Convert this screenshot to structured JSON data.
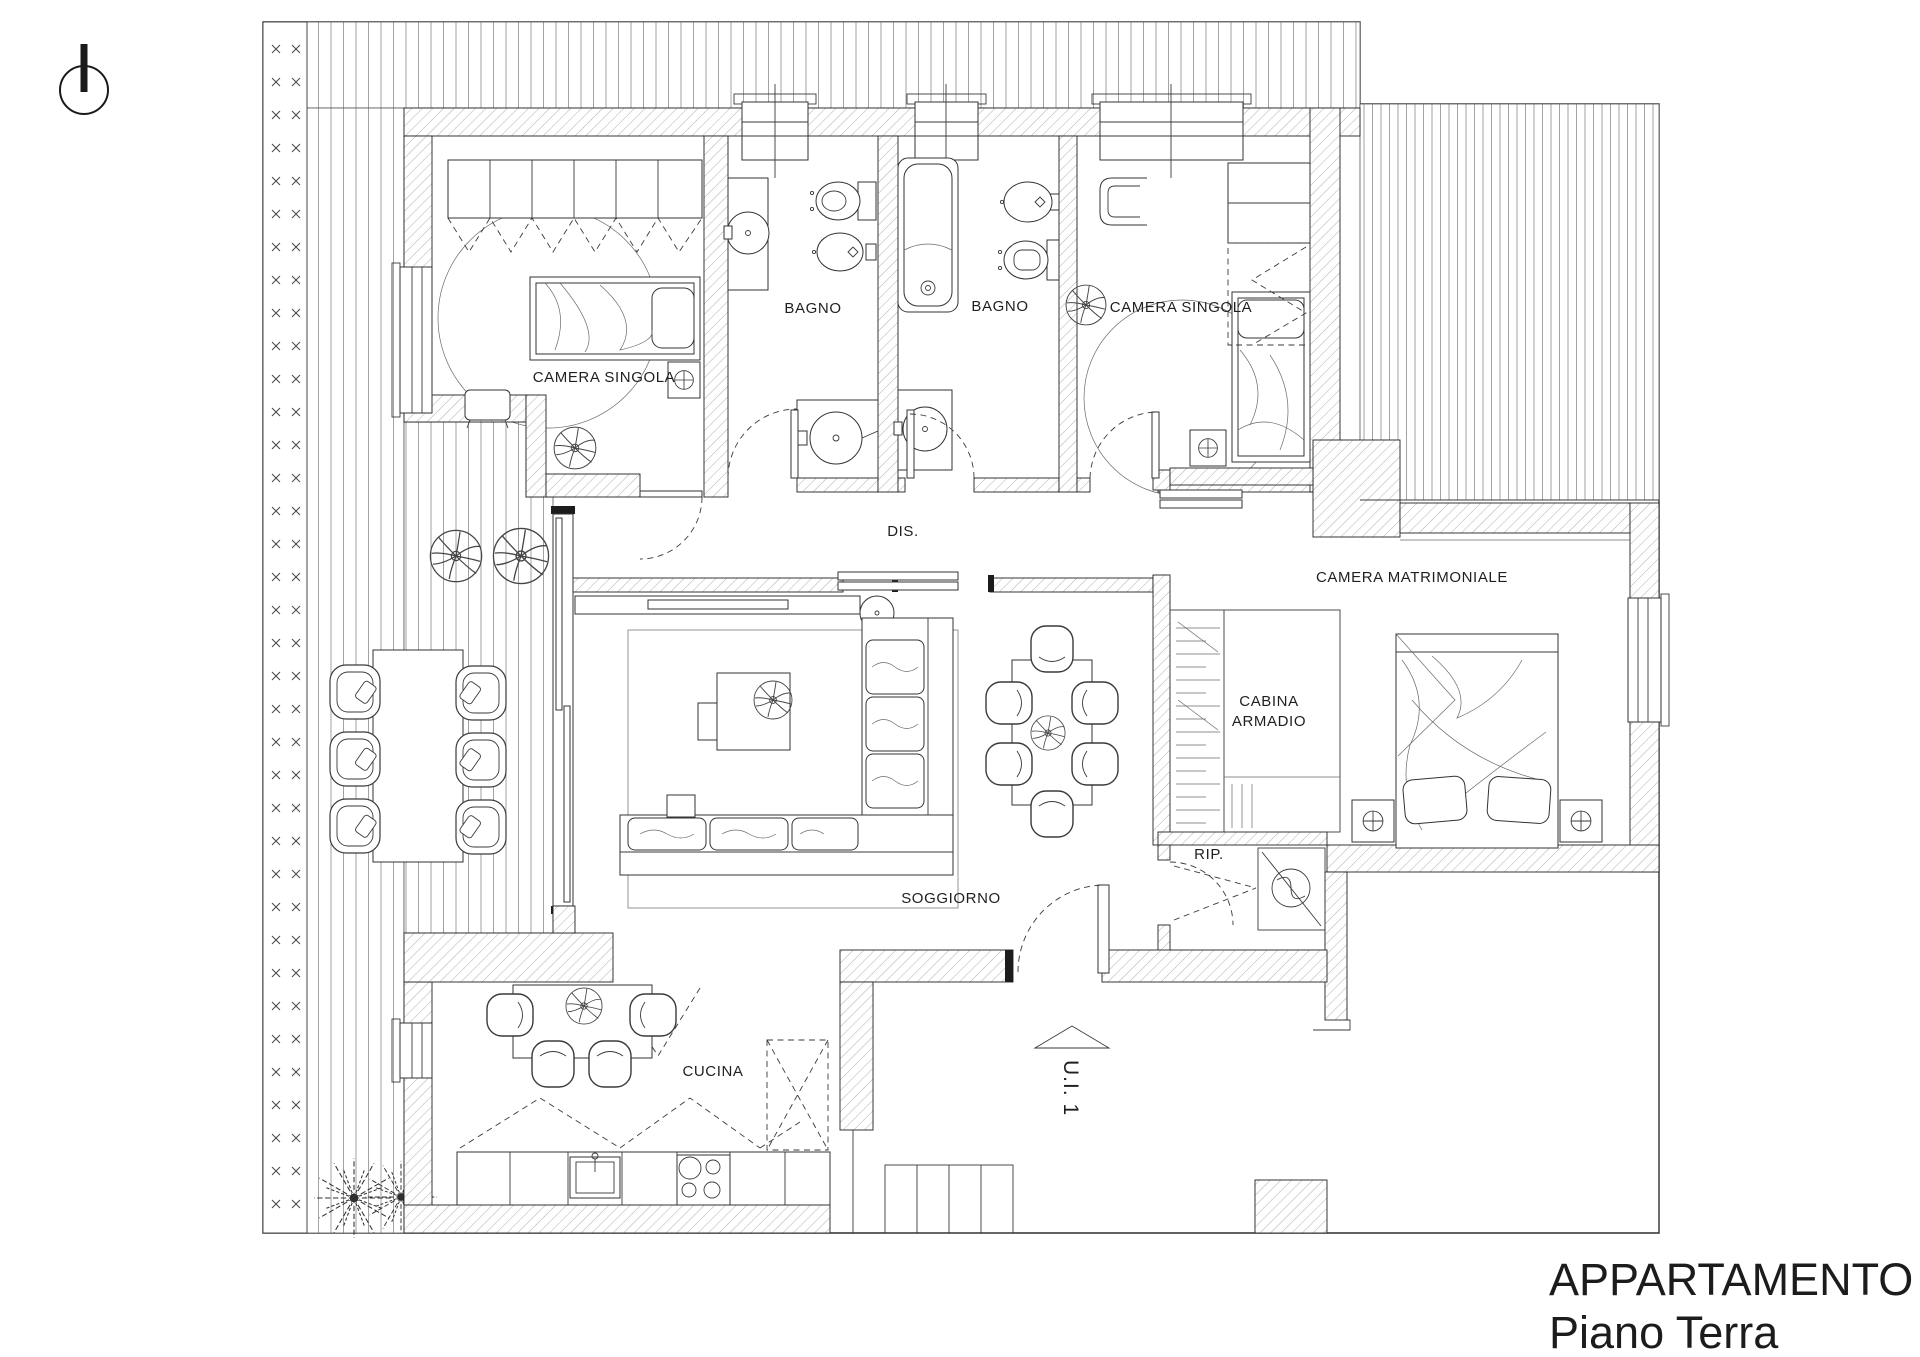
{
  "title": {
    "line1": "APPARTAMENTO 1",
    "line2": "Piano Terra"
  },
  "rooms": {
    "camera_singola_1": "CAMERA SINGOLA",
    "bagno_1": "BAGNO",
    "bagno_2": "BAGNO",
    "camera_singola_2": "CAMERA SINGOLA",
    "disimpegno": "DIS.",
    "camera_matrimoniale": "CAMERA MATRIMONIALE",
    "cabina_armadio_line1": "CABINA",
    "cabina_armadio_line2": "ARMADIO",
    "ripostiglio": "RIP.",
    "soggiorno": "SOGGIORNO",
    "cucina": "CUCINA",
    "unit_label": "U.I. 1"
  },
  "colors": {
    "wall_line": "#222222",
    "hatch_line": "#b0b0b0",
    "deck_line": "#8a8a8a",
    "text": "#1f1f1f"
  }
}
